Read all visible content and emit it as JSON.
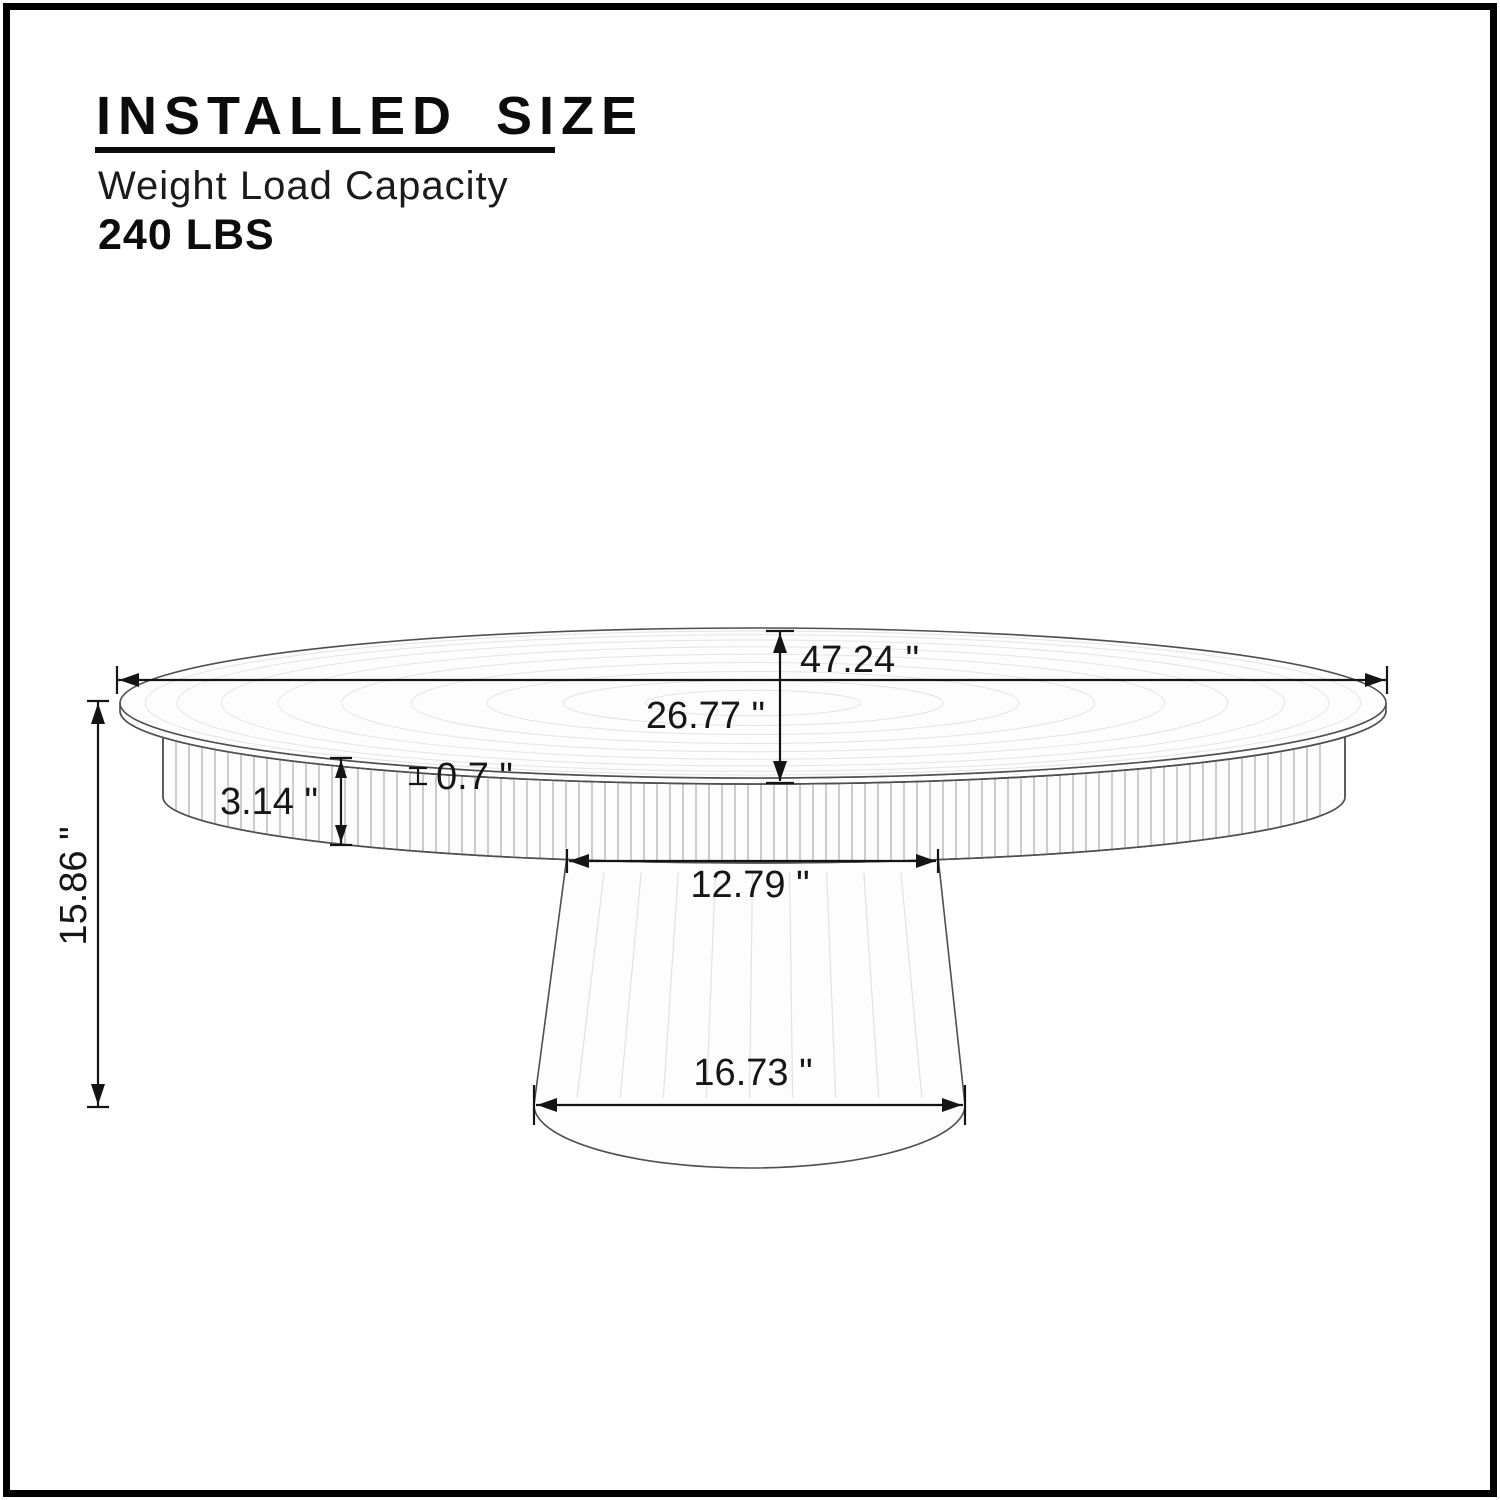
{
  "header": {
    "title": "INSTALLED SIZE",
    "subtitle": "Weight Load Capacity",
    "weight_capacity": "240 LBS"
  },
  "diagram": {
    "product": "round pedestal coffee table",
    "dimensions": {
      "top_diameter": "47.24 \"",
      "top_depth": "26.77 \"",
      "top_thickness": "0.7 \"",
      "apron_height": "3.14 \"",
      "pedestal_top_width": "12.79 \"",
      "pedestal_base_width": "16.73 \"",
      "overall_height": "15.86 \""
    }
  }
}
